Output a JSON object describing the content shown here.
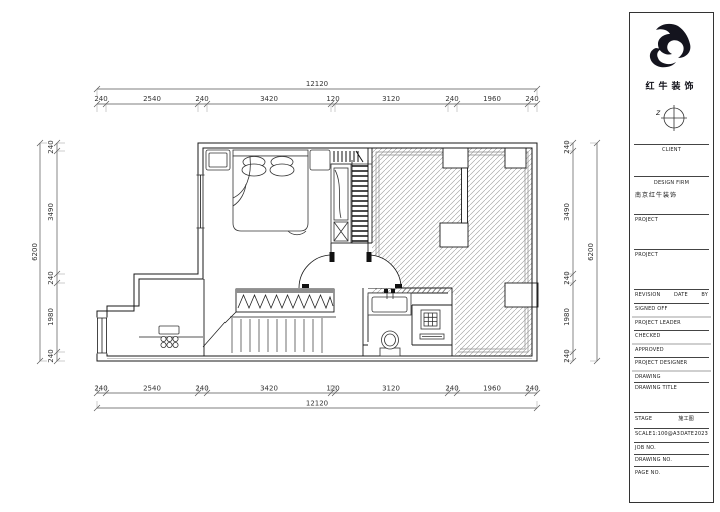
{
  "sheet": {
    "logo_text": "红牛装饰",
    "compass_label": "z"
  },
  "title_block": {
    "client_label": "CLIENT",
    "design_firm_label": "DESIGN FIRM",
    "design_firm_value": "南京红牛装饰",
    "project1_label": "PROJECT",
    "project2_label": "PROJECT",
    "revision_label": "REVISION",
    "date_label": "DATE",
    "by_label": "BY",
    "signed_off_label": "SIGNED OFF",
    "project_leader_label": "PROJECT LEADER",
    "checked_label": "CHECKED",
    "approved_label": "APPROVED",
    "project_designer_label": "PROJECT DESIGNER",
    "drawing_label": "DRAWING",
    "drawing_title_label": "DRAWING TITLE",
    "stage_label": "STAGE",
    "stage_value": "施工图",
    "scale_label": "SCALE",
    "scale_value": "1:100@A3",
    "date2_label": "DATE",
    "date_value": "2023",
    "job_no_label": "JOB NO.",
    "drawing_no_label": "DRAWING NO.",
    "page_no_label": "PAGE NO."
  },
  "dims": {
    "top": {
      "total": "12120",
      "segments": [
        "240",
        "2540",
        "240",
        "3420",
        "120",
        "3120",
        "240",
        "1960",
        "240"
      ]
    },
    "bottom": {
      "total": "12120",
      "segments": [
        "240",
        "2540",
        "240",
        "3420",
        "120",
        "3120",
        "240",
        "1960",
        "240"
      ]
    },
    "left": {
      "total": "6200",
      "segments": [
        "240",
        "3490",
        "240",
        "1980",
        "240"
      ]
    },
    "right": {
      "total": "6200",
      "segments": [
        "240",
        "3490",
        "240",
        "1980",
        "240"
      ]
    }
  }
}
